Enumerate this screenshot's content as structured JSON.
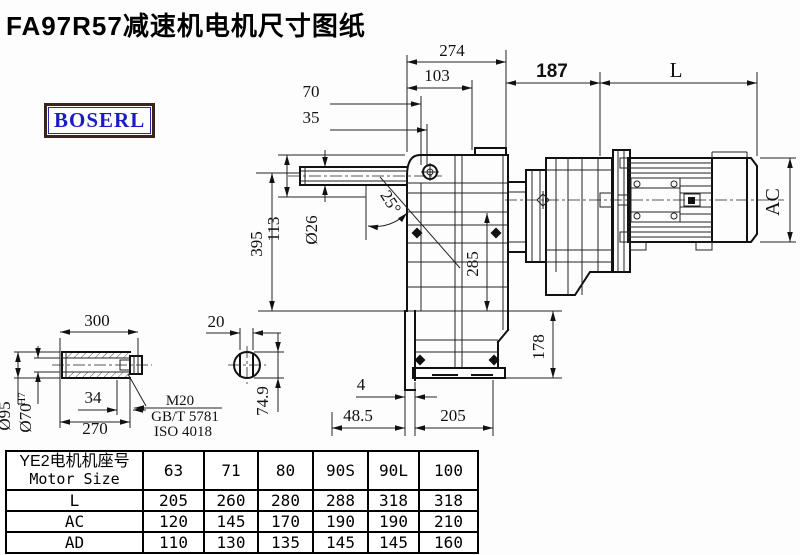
{
  "title": "FA97R57减速机电机尺寸图纸",
  "logo": "BOSERL",
  "dims": {
    "w274": "274",
    "w103": "103",
    "w70": "70",
    "w35": "35",
    "w187": "187",
    "length_L": "L",
    "ac": "AC",
    "angle": "25°",
    "dia26": "Ø26",
    "h113": "113",
    "h395": "395",
    "h285": "285",
    "h178": "178",
    "t4": "4",
    "w48_5": "48.5",
    "w205": "205",
    "s300": "300",
    "s270": "270",
    "s34": "34",
    "dia95": "Ø95",
    "dia70": "Ø70",
    "dia70_tol": "H7",
    "thread": "M20",
    "std1": "GB/T 5781",
    "std2": "ISO 4018",
    "s20": "20",
    "dia74_9": "74.9"
  },
  "table": {
    "header_cn": "YE2电机机座号",
    "header_en": "Motor Size",
    "sizes": [
      "63",
      "71",
      "80",
      "90S",
      "90L",
      "100"
    ],
    "rows": [
      {
        "label": "L",
        "values": [
          "205",
          "260",
          "280",
          "288",
          "318",
          "318"
        ]
      },
      {
        "label": "AC",
        "values": [
          "120",
          "145",
          "170",
          "190",
          "190",
          "210"
        ]
      },
      {
        "label": "AD",
        "values": [
          "110",
          "130",
          "135",
          "145",
          "145",
          "160"
        ]
      }
    ]
  }
}
